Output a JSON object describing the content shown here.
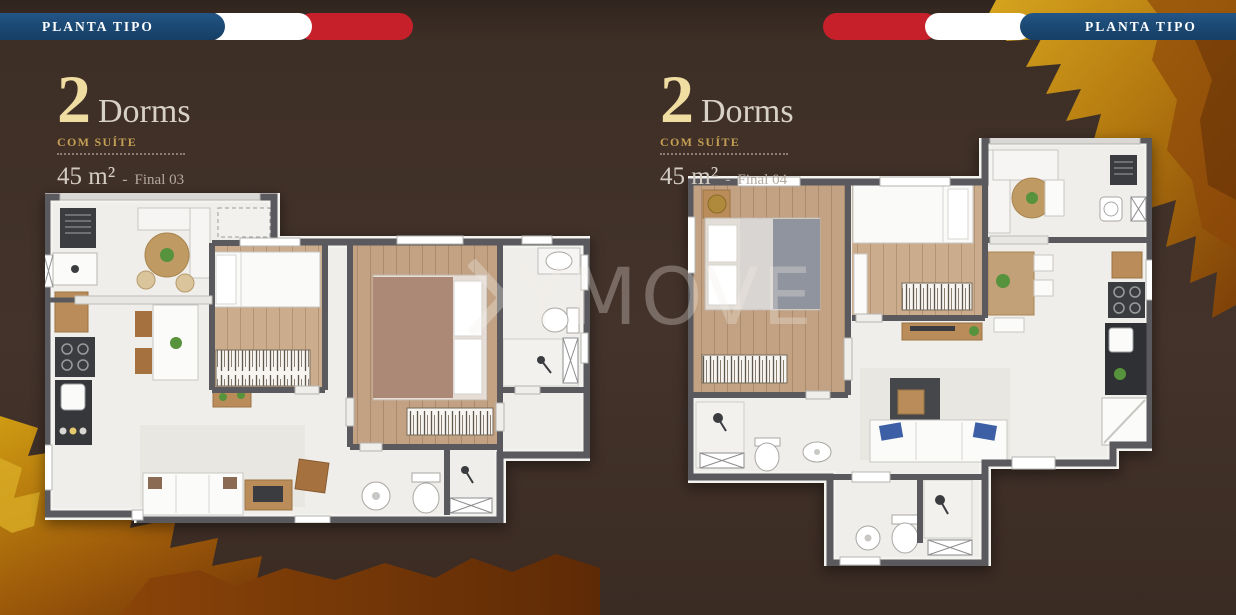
{
  "header": {
    "left_ribbon": {
      "label": "PLANTA TIPO"
    },
    "right_ribbon": {
      "label": "PLANTA TIPO"
    }
  },
  "units": [
    {
      "number": "2",
      "type": "Dorms",
      "subtitle": "COM SUÍTE",
      "area": "45 m²",
      "separator": "-",
      "final": "Final 03"
    },
    {
      "number": "2",
      "type": "Dorms",
      "subtitle": "COM SUÍTE",
      "area": "45 m²",
      "separator": "-",
      "final": "Final 04"
    }
  ],
  "watermark": {
    "text": "YMOVE",
    "icon": "chevron-right-icon"
  },
  "colors": {
    "background": "#3e2f26",
    "ribbon_blue": "#1c4a75",
    "ribbon_red": "#c6202b",
    "ribbon_white": "#ffffff",
    "gold_number": "#f0dda2",
    "gold_subtitle": "#c49f54",
    "leaf_gold": "#c8960e",
    "leaf_rust": "#7a3a08",
    "wall_gray": "#5a5a5e",
    "wood_floor": "#c4a585"
  }
}
